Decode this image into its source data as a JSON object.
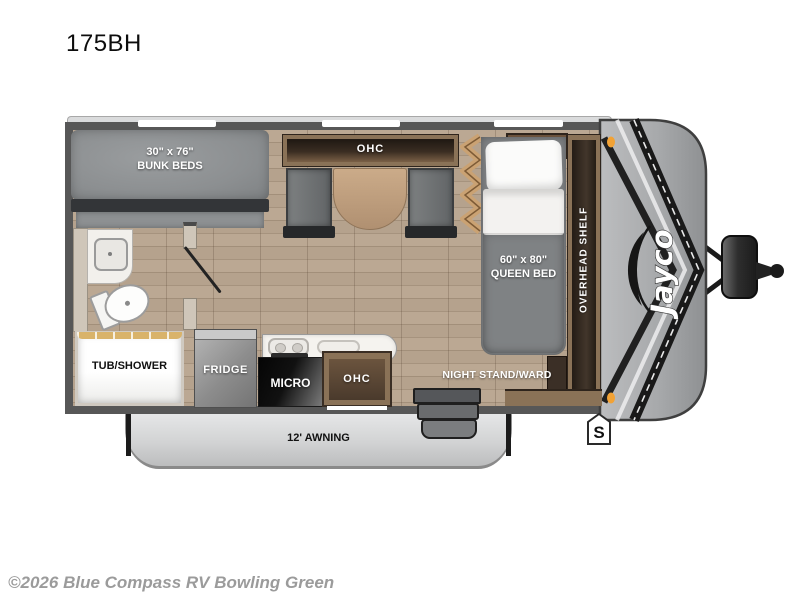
{
  "window": {
    "title": "175BH",
    "copyright": "©2026 Blue Compass RV Bowling Green"
  },
  "floorplan": {
    "model": "175BH",
    "brand_logo": "Jayco",
    "badge_label": "S",
    "labels": {
      "bunk_size": "30\" x 76\"",
      "bunk": "BUNK BEDS",
      "dinette_ohc": "OHC",
      "ac": "A/C",
      "queen_size": "60\" x 80\"",
      "queen": "QUEEN BED",
      "overhead_shelf": "OVERHEAD SHELF",
      "tub_shower": "TUB/SHOWER",
      "fridge": "FRIDGE",
      "micro": "MICRO",
      "kitchen_ohc": "OHC",
      "nightstand": "NIGHT STAND/WARD",
      "awning": "12' AWNING"
    },
    "colors": {
      "wall": "#575757",
      "floor_wood": "#b5a28d",
      "cabinet_wood": "#8a7257",
      "mattress_gray": "#8c8f91",
      "front_cap_gray": "#a7a9ab",
      "marker_light_orange": "#f2a235",
      "awning_gray": "#d2d3d4"
    }
  }
}
